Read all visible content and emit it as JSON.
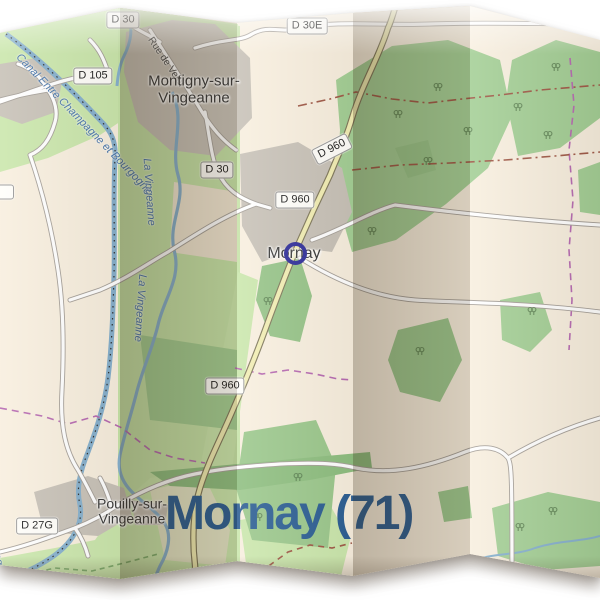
{
  "title": {
    "text": "Mornay (71)",
    "color": "#2d5f94"
  },
  "map": {
    "towns": [
      {
        "name": "Montigny-sur-Vingeanne",
        "line1": "Montigny-sur-",
        "line2": "Vingeanne"
      },
      {
        "name": "Mornay"
      },
      {
        "name": "Pouilly-sur-Vingeanne",
        "line1": "Pouilly-sur-",
        "line2": "Vingeanne"
      }
    ],
    "road_labels": [
      {
        "text": "D 30"
      },
      {
        "text": "D 30"
      },
      {
        "text": "D 30E"
      },
      {
        "text": "D 105"
      },
      {
        "text": "D 960"
      },
      {
        "text": "D 960"
      },
      {
        "text": "D 960"
      },
      {
        "text": "D 27G"
      }
    ],
    "street_labels": [
      {
        "text": "Rue de Velet"
      }
    ],
    "water_labels": [
      {
        "text": "Canal Entre Champagne et Bourgogne"
      },
      {
        "text": "La Vingeanne"
      },
      {
        "text": "La Vingeanne"
      },
      {
        "text": "Bourgogne"
      }
    ],
    "marker": {
      "type": "circle-marker",
      "ring_color": "#31309b"
    },
    "colors": {
      "land": "#f8efdf",
      "meadow": "#cbe7ad",
      "forest": "#a4cf96",
      "forest_dark": "#8fbf81",
      "urban": "#c8c2b8",
      "water": "#86b0cd",
      "road_primary_fill": "#f2eeb4",
      "boundary_purple": "#b76bb2",
      "boundary_brown": "#a05a48",
      "label_text": "#222222",
      "town_text": "#3a3a3a",
      "water_text": "#4a77ab",
      "title_blue": "#2d5f94"
    }
  }
}
